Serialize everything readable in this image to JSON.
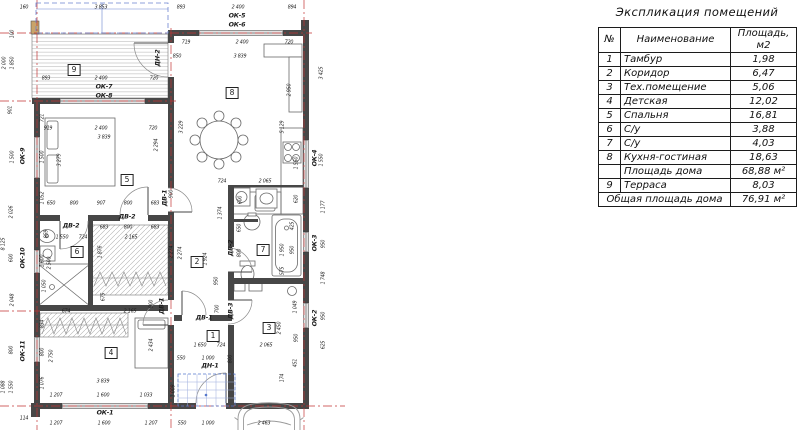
{
  "table": {
    "title": "Экспликация помещений",
    "headers": {
      "num": "№",
      "name": "Наименование",
      "area": "Площадь, м2"
    },
    "rows": [
      {
        "num": "1",
        "name": "Тамбур",
        "area": "1,98"
      },
      {
        "num": "2",
        "name": "Коридор",
        "area": "6,47"
      },
      {
        "num": "3",
        "name": "Тех.помещение",
        "area": "5,06"
      },
      {
        "num": "4",
        "name": "Детская",
        "area": "12,02"
      },
      {
        "num": "5",
        "name": "Спальня",
        "area": "16,81"
      },
      {
        "num": "6",
        "name": "С/у",
        "area": "3,88"
      },
      {
        "num": "7",
        "name": "С/у",
        "area": "4,03"
      },
      {
        "num": "8",
        "name": "Кухня-гостиная",
        "area": "18,63"
      },
      {
        "num": "",
        "name": "Площадь дома",
        "area": "68,88 м²"
      },
      {
        "num": "9",
        "name": "Терраса",
        "area": "8,03"
      },
      {
        "merged": true,
        "name": "Общая площадь дома",
        "area": "76,91 м²"
      }
    ]
  },
  "plan": {
    "room_numbers": [
      {
        "t": "9",
        "x": 74,
        "y": 70
      },
      {
        "t": "8",
        "x": 232,
        "y": 93
      },
      {
        "t": "5",
        "x": 127,
        "y": 180
      },
      {
        "t": "6",
        "x": 77,
        "y": 252
      },
      {
        "t": "2",
        "x": 197,
        "y": 262
      },
      {
        "t": "7",
        "x": 263,
        "y": 250
      },
      {
        "t": "4",
        "x": 111,
        "y": 353
      },
      {
        "t": "1",
        "x": 213,
        "y": 336
      },
      {
        "t": "3",
        "x": 269,
        "y": 328
      }
    ],
    "window_labels": [
      {
        "t": "ОК-5",
        "x": 237,
        "y": 16
      },
      {
        "t": "ОК-6",
        "x": 237,
        "y": 25
      },
      {
        "t": "ОК-7",
        "x": 104,
        "y": 87
      },
      {
        "t": "ОК-8",
        "x": 104,
        "y": 96
      },
      {
        "t": "ОК-9",
        "x": 23,
        "y": 156,
        "v": 1
      },
      {
        "t": "ОК-10",
        "x": 23,
        "y": 258,
        "v": 1
      },
      {
        "t": "ОК-11",
        "x": 23,
        "y": 351,
        "v": 1
      },
      {
        "t": "ОК-1",
        "x": 105,
        "y": 413
      },
      {
        "t": "ОК-4",
        "x": 315,
        "y": 158,
        "v": 1
      },
      {
        "t": "ОК-3",
        "x": 315,
        "y": 243,
        "v": 1
      },
      {
        "t": "ОК-2",
        "x": 315,
        "y": 318,
        "v": 1
      }
    ],
    "door_labels": [
      {
        "t": "ДН-2",
        "x": 158,
        "y": 58,
        "v": 1
      },
      {
        "t": "ДВ-1",
        "x": 165,
        "y": 198,
        "v": 1
      },
      {
        "t": "ДВ-2",
        "x": 127,
        "y": 217
      },
      {
        "t": "ДВ-2",
        "x": 71,
        "y": 226
      },
      {
        "t": "ДВ-2",
        "x": 231,
        "y": 248,
        "v": 1
      },
      {
        "t": "ДВ-1",
        "x": 162,
        "y": 306,
        "v": 1
      },
      {
        "t": "ДВ-1",
        "x": 204,
        "y": 318
      },
      {
        "t": "ДВ-3",
        "x": 231,
        "y": 311,
        "v": 1
      },
      {
        "t": "ДН-1",
        "x": 210,
        "y": 366
      }
    ],
    "dims": [
      {
        "t": "160",
        "x": 24,
        "y": 8
      },
      {
        "t": "3 853",
        "x": 101,
        "y": 8
      },
      {
        "t": "893",
        "x": 181,
        "y": 8
      },
      {
        "t": "2 400",
        "x": 238,
        "y": 8
      },
      {
        "t": "894",
        "x": 292,
        "y": 8
      },
      {
        "t": "719",
        "x": 186,
        "y": 43
      },
      {
        "t": "2 400",
        "x": 242,
        "y": 43
      },
      {
        "t": "720",
        "x": 289,
        "y": 43
      },
      {
        "t": "850",
        "x": 177,
        "y": 57
      },
      {
        "t": "3 839",
        "x": 240,
        "y": 57
      },
      {
        "t": "893",
        "x": 46,
        "y": 79
      },
      {
        "t": "2 400",
        "x": 101,
        "y": 79
      },
      {
        "t": "720",
        "x": 154,
        "y": 79
      },
      {
        "t": "919",
        "x": 48,
        "y": 129
      },
      {
        "t": "2 400",
        "x": 101,
        "y": 129
      },
      {
        "t": "720",
        "x": 153,
        "y": 129
      },
      {
        "t": "3 839",
        "x": 104,
        "y": 138
      },
      {
        "t": "100",
        "x": 13,
        "y": 34,
        "v": 1
      },
      {
        "t": "2 000",
        "x": 5,
        "y": 63,
        "v": 1
      },
      {
        "t": "1 850",
        "x": 13,
        "y": 63,
        "v": 1
      },
      {
        "t": "901",
        "x": 11,
        "y": 110,
        "v": 1
      },
      {
        "t": "1 500",
        "x": 13,
        "y": 157,
        "v": 1
      },
      {
        "t": "1 500",
        "x": 43,
        "y": 157,
        "v": 1
      },
      {
        "t": "2 026",
        "x": 12,
        "y": 212,
        "v": 1
      },
      {
        "t": "8 125",
        "x": 4,
        "y": 244,
        "v": 1
      },
      {
        "t": "600",
        "x": 12,
        "y": 258,
        "v": 1
      },
      {
        "t": "2 048",
        "x": 13,
        "y": 300,
        "v": 1
      },
      {
        "t": "800",
        "x": 12,
        "y": 350,
        "v": 1
      },
      {
        "t": "1 088",
        "x": 4,
        "y": 387,
        "v": 1
      },
      {
        "t": "1 550",
        "x": 12,
        "y": 387,
        "v": 1
      },
      {
        "t": "721",
        "x": 43,
        "y": 118,
        "v": 1
      },
      {
        "t": "3 279",
        "x": 60,
        "y": 160,
        "v": 1
      },
      {
        "t": "1 052",
        "x": 43,
        "y": 198,
        "v": 1
      },
      {
        "t": "859",
        "x": 47,
        "y": 234,
        "v": 1
      },
      {
        "t": "1 600",
        "x": 43,
        "y": 261,
        "v": 1
      },
      {
        "t": "2 500",
        "x": 50,
        "y": 263,
        "v": 1
      },
      {
        "t": "1 050",
        "x": 45,
        "y": 286,
        "v": 1
      },
      {
        "t": "834",
        "x": 43,
        "y": 324,
        "v": 1
      },
      {
        "t": "800",
        "x": 43,
        "y": 352,
        "v": 1
      },
      {
        "t": "2 750",
        "x": 52,
        "y": 356,
        "v": 1
      },
      {
        "t": "1 076",
        "x": 43,
        "y": 383,
        "v": 1
      },
      {
        "t": "650",
        "x": 51,
        "y": 204
      },
      {
        "t": "800",
        "x": 74,
        "y": 204
      },
      {
        "t": "907",
        "x": 101,
        "y": 204
      },
      {
        "t": "800",
        "x": 128,
        "y": 204
      },
      {
        "t": "683",
        "x": 155,
        "y": 204
      },
      {
        "t": "683",
        "x": 104,
        "y": 228
      },
      {
        "t": "800",
        "x": 128,
        "y": 228
      },
      {
        "t": "683",
        "x": 155,
        "y": 228
      },
      {
        "t": "1 550",
        "x": 62,
        "y": 238
      },
      {
        "t": "724",
        "x": 83,
        "y": 238
      },
      {
        "t": "2 165",
        "x": 131,
        "y": 238
      },
      {
        "t": "1 876",
        "x": 101,
        "y": 252,
        "v": 1
      },
      {
        "t": "2 274",
        "x": 172,
        "y": 252,
        "v": 1
      },
      {
        "t": "900",
        "x": 172,
        "y": 194,
        "v": 1
      },
      {
        "t": "675",
        "x": 104,
        "y": 297,
        "v": 1
      },
      {
        "t": "674",
        "x": 66,
        "y": 312
      },
      {
        "t": "2 165",
        "x": 130,
        "y": 312
      },
      {
        "t": "900",
        "x": 152,
        "y": 304,
        "v": 1
      },
      {
        "t": "2 434",
        "x": 152,
        "y": 345,
        "v": 1
      },
      {
        "t": "3 839",
        "x": 103,
        "y": 382
      },
      {
        "t": "1 207",
        "x": 56,
        "y": 396
      },
      {
        "t": "1 600",
        "x": 103,
        "y": 396
      },
      {
        "t": "1 033",
        "x": 146,
        "y": 396
      },
      {
        "t": "114",
        "x": 24,
        "y": 419
      },
      {
        "t": "1 207",
        "x": 56,
        "y": 424
      },
      {
        "t": "1 600",
        "x": 104,
        "y": 424
      },
      {
        "t": "1 207",
        "x": 151,
        "y": 424
      },
      {
        "t": "550",
        "x": 182,
        "y": 424
      },
      {
        "t": "1 000",
        "x": 208,
        "y": 424
      },
      {
        "t": "2 463",
        "x": 264,
        "y": 424
      },
      {
        "t": "3 229",
        "x": 182,
        "y": 127,
        "v": 1
      },
      {
        "t": "2 294",
        "x": 157,
        "y": 145,
        "v": 1
      },
      {
        "t": "2 950",
        "x": 290,
        "y": 90,
        "v": 1
      },
      {
        "t": "5 129",
        "x": 283,
        "y": 127,
        "v": 1
      },
      {
        "t": "1 550",
        "x": 297,
        "y": 163,
        "v": 1
      },
      {
        "t": "620",
        "x": 297,
        "y": 199,
        "v": 1
      },
      {
        "t": "3 425",
        "x": 322,
        "y": 73,
        "v": 1
      },
      {
        "t": "1 550",
        "x": 322,
        "y": 160,
        "v": 1
      },
      {
        "t": "1 177",
        "x": 324,
        "y": 207,
        "v": 1
      },
      {
        "t": "950",
        "x": 324,
        "y": 244,
        "v": 1
      },
      {
        "t": "1 748",
        "x": 324,
        "y": 278,
        "v": 1
      },
      {
        "t": "950",
        "x": 324,
        "y": 316,
        "v": 1
      },
      {
        "t": "625",
        "x": 324,
        "y": 345,
        "v": 1
      },
      {
        "t": "724",
        "x": 222,
        "y": 182
      },
      {
        "t": "2 065",
        "x": 265,
        "y": 182
      },
      {
        "t": "600",
        "x": 241,
        "y": 200,
        "v": 1
      },
      {
        "t": "1 374",
        "x": 221,
        "y": 213,
        "v": 1
      },
      {
        "t": "1 924",
        "x": 206,
        "y": 259,
        "v": 1
      },
      {
        "t": "2 274",
        "x": 181,
        "y": 253,
        "v": 1
      },
      {
        "t": "950",
        "x": 217,
        "y": 281,
        "v": 1
      },
      {
        "t": "700",
        "x": 218,
        "y": 309,
        "v": 1
      },
      {
        "t": "650",
        "x": 240,
        "y": 228,
        "v": 1
      },
      {
        "t": "800",
        "x": 240,
        "y": 253,
        "v": 1
      },
      {
        "t": "425",
        "x": 293,
        "y": 226,
        "v": 1
      },
      {
        "t": "1 950",
        "x": 283,
        "y": 250,
        "v": 1
      },
      {
        "t": "950",
        "x": 293,
        "y": 250,
        "v": 1
      },
      {
        "t": "575",
        "x": 283,
        "y": 271,
        "v": 1
      },
      {
        "t": "1 049",
        "x": 296,
        "y": 307,
        "v": 1
      },
      {
        "t": "2 450",
        "x": 280,
        "y": 328,
        "v": 1
      },
      {
        "t": "950",
        "x": 297,
        "y": 338,
        "v": 1
      },
      {
        "t": "451",
        "x": 296,
        "y": 363,
        "v": 1
      },
      {
        "t": "174",
        "x": 283,
        "y": 378,
        "v": 1
      },
      {
        "t": "1 650",
        "x": 200,
        "y": 346
      },
      {
        "t": "724",
        "x": 221,
        "y": 346
      },
      {
        "t": "2 065",
        "x": 266,
        "y": 346
      },
      {
        "t": "550",
        "x": 181,
        "y": 359
      },
      {
        "t": "1 000",
        "x": 208,
        "y": 359
      },
      {
        "t": "800",
        "x": 231,
        "y": 359,
        "v": 1
      },
      {
        "t": "1 009",
        "x": 174,
        "y": 391,
        "v": 1
      }
    ]
  }
}
